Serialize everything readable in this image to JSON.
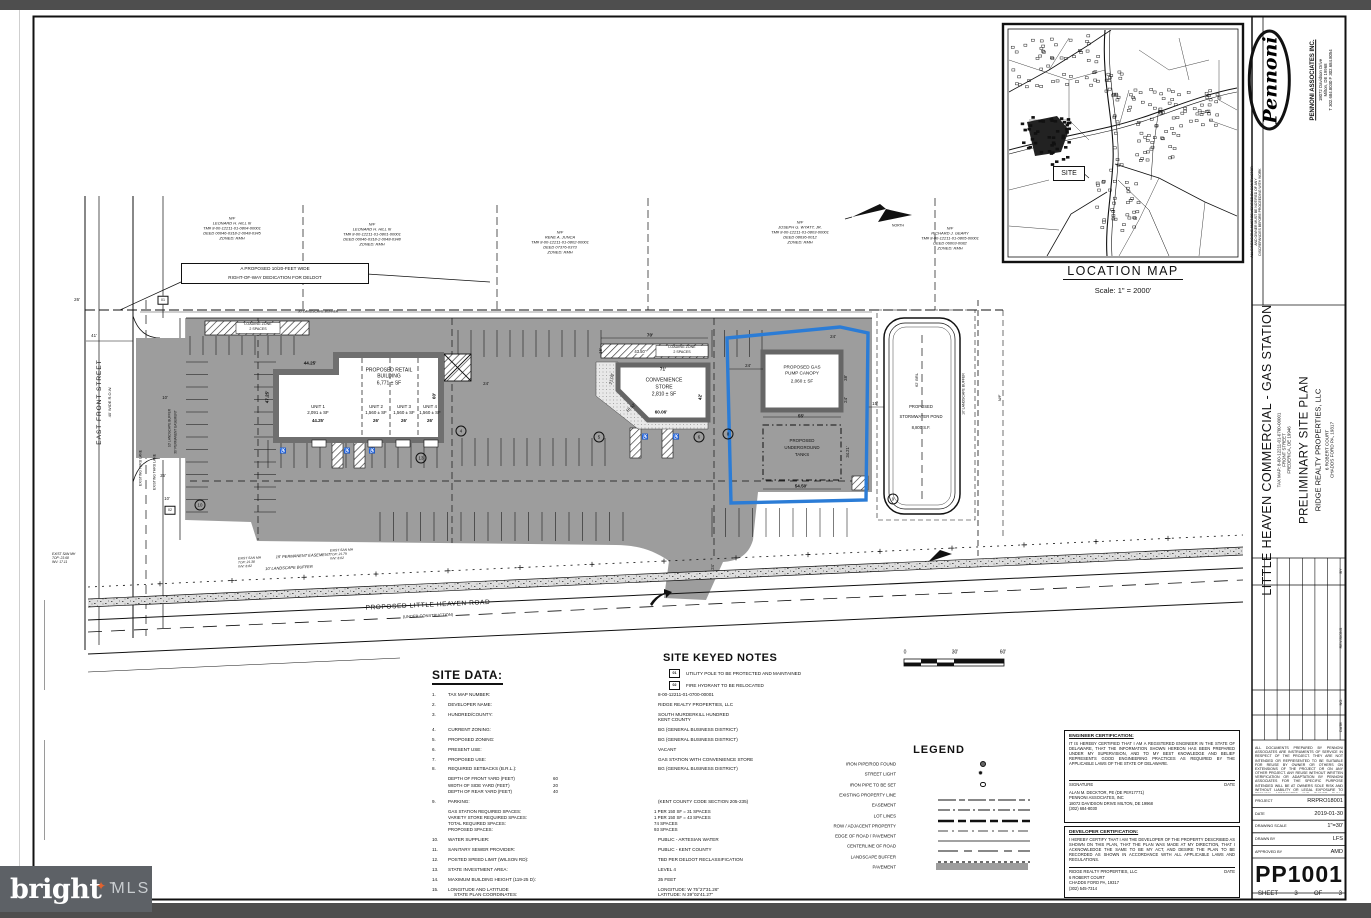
{
  "watermark": {
    "brand": "bright",
    "suffix": "MLS",
    "tm": "™",
    "star": "✦"
  },
  "titleblock": {
    "firm": {
      "logo_text": "Pennoni",
      "name": "PENNONI ASSOCIATES INC.",
      "address1": "18072 Davidson Drive",
      "address2": "Milton, DE 19968",
      "phone": "T 302.684.8030    F 302.684.8054"
    },
    "vertical_note_lines": [
      "ALL DIMENSIONS MUST BE VERIFIED BY CONTRACTOR",
      "AND OWNER MUST BE NOTIFIED OF ANY",
      "DISCREPANCIES BEFORE PROCEEDING WITH WORK"
    ],
    "project": {
      "title": "LITTLE HEAVEN COMMERCIAL - GAS STATION",
      "tax_map": "TAX MAP: 8-00-12211-01-0700-00001",
      "street": "FRONT STREET",
      "city": "FREDERICA, DE 19946",
      "plan_type": "PRELIMINARY SITE PLAN",
      "client_name": "RIDGE REALTY PROPERTIES, LLC",
      "client_address1": "6 ROBERT COURT",
      "client_address2": "CHADDS FORD PA, 19317"
    },
    "revisions": {
      "label": "REVISIONS",
      "col_no": "NO.",
      "col_date": "DATE",
      "col_by": "BY"
    },
    "reuse_note": "ALL DOCUMENTS PREPARED BY PENNONI ASSOCIATES ARE INSTRUMENTS OF SERVICE IN RESPECT OF THE PROJECT. THEY ARE NOT INTENDED OR REPRESENTED TO BE SUITABLE FOR REUSE BY OWNER OR OTHERS ON EXTENSIONS OF THE PROJECT OR ON ANY OTHER PROJECT. ANY REUSE WITHOUT WRITTEN VERIFICATION OR ADAPTATION BY PENNONI ASSOCIATES FOR THE SPECIFIC PURPOSE INTENDED WILL BE AT OWNERS SOLE RISK AND WITHOUT LIABILITY OR LEGAL EXPOSURE TO PENNONI ASSOCIATES AND OWNER SHALL INDEMNIFY AND HOLD HARMLESS PENNONI ASSOCIATES FROM ALL CLAIMS, DAMAGES, LOSSES AND EXPENSES ARISING OUT OF OR RESULTING THEREFROM.",
    "info_rows": [
      {
        "label": "PROJECT",
        "value": "RRPRO18001"
      },
      {
        "label": "DATE",
        "value": "2019-01-30"
      },
      {
        "label": "DRAWING SCALE",
        "value": "1\"=30'"
      },
      {
        "label": "DRAWN BY",
        "value": "LFS"
      },
      {
        "label": "APPROVED BY",
        "value": "AMD"
      }
    ],
    "sheet_number": "PP1001",
    "sheet_label": "SHEET",
    "sheet_page": "3",
    "sheet_of": "OF",
    "sheet_total": "3"
  },
  "location_map": {
    "title": "LOCATION MAP",
    "scale": "Scale: 1\" = 2000'",
    "site_label": "SITE"
  },
  "scale_bar": {
    "zero": "0",
    "mid": "30'",
    "end": "60'"
  },
  "plan": {
    "labels": [
      {
        "t": "EAST FRONT STREET",
        "x": 100,
        "y": 402,
        "r": -90,
        "s": 6.5,
        "ls": 1,
        "n": "east-front-street-label"
      },
      {
        "t": "40' WIDE R.O.W.",
        "x": 110,
        "y": 402,
        "r": -90,
        "s": 4
      },
      {
        "t": "EXISTING THRU LANE",
        "x": 141,
        "y": 468,
        "r": -90,
        "s": 3.4
      },
      {
        "t": "EXISTING THRU LANE",
        "x": 155,
        "y": 472,
        "r": -90,
        "s": 3.4
      },
      {
        "t": "PROPOSED LITTLE HEAVEN ROAD",
        "x": 428,
        "y": 606,
        "r": -2.6,
        "s": 6.5,
        "ls": 0.6,
        "n": "little-heaven-road-label"
      },
      {
        "t": "(UNDER CONSTRUCTION)",
        "x": 428,
        "y": 616,
        "r": -2.6,
        "s": 4
      },
      {
        "t": "15' PERMANENT EASEMENT",
        "x": 303,
        "y": 556,
        "r": -2.6,
        "s": 4,
        "i": 1
      },
      {
        "t": "10' LANDSCAPE BUFFER",
        "x": 289,
        "y": 568,
        "r": -2.6,
        "s": 4,
        "i": 1
      },
      {
        "t": "30' LANDSCAPE BUFFER",
        "x": 318,
        "y": 312,
        "s": 3.4,
        "i": 1
      },
      {
        "t": "10' LANDSCAPE BUFFER",
        "x": 170,
        "y": 428,
        "r": -90,
        "s": 3.2
      },
      {
        "t": "30' PERMANENT EASEMENT",
        "x": 176,
        "y": 432,
        "r": -90,
        "s": 3.2
      },
      {
        "t": "10' LANDSCAPE BUFFER",
        "x": 964,
        "y": 394,
        "r": -90,
        "s": 3.5
      },
      {
        "t": "62' BRL",
        "x": 917,
        "y": 380,
        "r": -90,
        "s": 4
      },
      {
        "t": "N/F",
        "x": 1000,
        "y": 398,
        "r": -90,
        "s": 4,
        "i": 1
      },
      {
        "t": "NORTH",
        "x": 898,
        "y": 226,
        "s": 3.4,
        "n": "north-arrow-label"
      },
      {
        "t": "PROPOSED RETAIL",
        "x": 389,
        "y": 371,
        "s": 5,
        "n": "retail-building-label"
      },
      {
        "t": "BUILDING",
        "x": 389,
        "y": 377,
        "s": 5
      },
      {
        "t": "6,771 ± SF",
        "x": 389,
        "y": 384,
        "s": 5
      },
      {
        "t": "UNIT 1",
        "x": 318,
        "y": 407,
        "s": 4.4
      },
      {
        "t": "2,091 ± SF",
        "x": 318,
        "y": 413,
        "s": 4.4
      },
      {
        "t": "44.25'",
        "x": 318,
        "y": 421,
        "s": 4.4,
        "b": 1
      },
      {
        "t": "UNIT 2",
        "x": 376,
        "y": 407,
        "s": 4.4
      },
      {
        "t": "1,560 ± SF",
        "x": 376,
        "y": 413,
        "s": 4.4
      },
      {
        "t": "26'",
        "x": 376,
        "y": 421,
        "s": 4.4,
        "b": 1
      },
      {
        "t": "UNIT 3",
        "x": 404,
        "y": 407,
        "s": 4.4
      },
      {
        "t": "1,560 ± SF",
        "x": 404,
        "y": 413,
        "s": 4.4
      },
      {
        "t": "26'",
        "x": 404,
        "y": 421,
        "s": 4.4,
        "b": 1
      },
      {
        "t": "UNIT 4",
        "x": 430,
        "y": 407,
        "s": 4.4
      },
      {
        "t": "1,560 ± SF",
        "x": 430,
        "y": 413,
        "s": 4.4
      },
      {
        "t": "26'",
        "x": 430,
        "y": 421,
        "s": 4.4,
        "b": 1
      },
      {
        "t": "44.25'",
        "x": 310,
        "y": 364,
        "s": 4.6,
        "b": 1
      },
      {
        "t": "47.25'",
        "x": 268,
        "y": 397,
        "r": -90,
        "s": 4.6,
        "b": 1
      },
      {
        "t": "60'",
        "x": 435,
        "y": 396,
        "r": -90,
        "s": 4.6,
        "b": 1
      },
      {
        "t": "24'",
        "x": 486,
        "y": 384,
        "s": 4.4
      },
      {
        "t": "CONVENIENCE",
        "x": 664,
        "y": 381,
        "s": 5,
        "n": "convenience-store-label"
      },
      {
        "t": "STORE",
        "x": 664,
        "y": 388,
        "s": 5
      },
      {
        "t": "2,810 ± SF",
        "x": 664,
        "y": 395,
        "s": 5
      },
      {
        "t": "71'",
        "x": 663,
        "y": 370,
        "s": 4.6,
        "b": 1
      },
      {
        "t": "21.08'",
        "x": 612,
        "y": 379,
        "r": -78,
        "s": 4.2
      },
      {
        "t": "18.52'",
        "x": 631,
        "y": 408,
        "r": -42,
        "s": 4.2
      },
      {
        "t": "60.06'",
        "x": 661,
        "y": 413,
        "s": 4.6,
        "b": 1
      },
      {
        "t": "42'",
        "x": 701,
        "y": 397,
        "r": -90,
        "s": 4.6,
        "b": 1
      },
      {
        "t": "70'",
        "x": 650,
        "y": 336,
        "s": 4.6,
        "b": 1
      },
      {
        "t": "15'",
        "x": 601,
        "y": 351,
        "r": -90,
        "s": 4.2
      },
      {
        "t": "43.50'",
        "x": 640,
        "y": 352,
        "s": 4.2,
        "bg": 1
      },
      {
        "t": "LOADING ZONE",
        "x": 682,
        "y": 348,
        "s": 3.6,
        "bg": 1
      },
      {
        "t": "2 SPACES",
        "x": 682,
        "y": 353,
        "s": 3.6,
        "bg": 1
      },
      {
        "t": "LOADING ZONE",
        "x": 258,
        "y": 325,
        "s": 3.6,
        "bg": 1
      },
      {
        "t": "2 SPACES",
        "x": 258,
        "y": 330,
        "s": 3.6,
        "bg": 1
      },
      {
        "t": "PROPOSED GAS",
        "x": 802,
        "y": 368,
        "s": 4.6,
        "n": "gas-canopy-label"
      },
      {
        "t": "PUMP CANOPY",
        "x": 802,
        "y": 374,
        "s": 4.6
      },
      {
        "t": "2,060 ± SF",
        "x": 802,
        "y": 382,
        "s": 4.6
      },
      {
        "t": "24'",
        "x": 748,
        "y": 366,
        "s": 4.4
      },
      {
        "t": "24'",
        "x": 833,
        "y": 337,
        "s": 4.4
      },
      {
        "t": "38'",
        "x": 846,
        "y": 378,
        "r": -90,
        "s": 4.4
      },
      {
        "t": "24'",
        "x": 846,
        "y": 400,
        "r": -90,
        "s": 4.4
      },
      {
        "t": "55'",
        "x": 801,
        "y": 417,
        "s": 4.6,
        "b": 1
      },
      {
        "t": "PROPOSED",
        "x": 802,
        "y": 441,
        "s": 4.4,
        "n": "underground-tanks-label"
      },
      {
        "t": "UNDERGROUND",
        "x": 802,
        "y": 448,
        "s": 4.4
      },
      {
        "t": "TANKS",
        "x": 802,
        "y": 455,
        "s": 4.4
      },
      {
        "t": "54.50'",
        "x": 801,
        "y": 487,
        "s": 4.6,
        "b": 1
      },
      {
        "t": "34.21'",
        "x": 848,
        "y": 452,
        "r": -90,
        "s": 4.2
      },
      {
        "t": "15'",
        "x": 875,
        "y": 404,
        "s": 4.4
      },
      {
        "t": "PROPOSED",
        "x": 921,
        "y": 407,
        "s": 4.2,
        "n": "stormwater-pond-label"
      },
      {
        "t": "STORMWATER POND",
        "x": 921,
        "y": 417,
        "s": 4.2
      },
      {
        "t": "8,800 S.F.",
        "x": 921,
        "y": 428,
        "s": 4.2
      },
      {
        "t": "41'",
        "x": 94,
        "y": 336,
        "s": 4.4
      },
      {
        "t": "26'",
        "x": 77,
        "y": 300,
        "s": 4.4
      },
      {
        "t": "10'",
        "x": 165,
        "y": 398,
        "s": 4.2
      },
      {
        "t": "25'",
        "x": 163,
        "y": 476,
        "s": 4.2
      },
      {
        "t": "10'",
        "x": 167,
        "y": 499,
        "s": 4.2
      },
      {
        "t": "24'",
        "x": 713,
        "y": 567,
        "r": -90,
        "s": 4.2
      }
    ],
    "parcels": [
      {
        "x": 232,
        "y": 228,
        "lines": [
          "N/F",
          "LEONARD H. HILL III",
          "TM# 8-00-12211-01-0804-00001",
          "DEED 00046-0318-2-0048-0345",
          "ZONED: RMH"
        ]
      },
      {
        "x": 372,
        "y": 234,
        "lines": [
          "N/F",
          "LEONARD H. HILL III",
          "TM# 8-00-12211-01-0801-00001",
          "DEED 00046-0318-2-0048-0348",
          "ZONED: RMH"
        ]
      },
      {
        "x": 560,
        "y": 242,
        "lines": [
          "N/F",
          "RENE A. JUNCA",
          "TM# 8-00-12211-01-0802-00001",
          "DEED 07376-0373",
          "ZONED: RMH"
        ]
      },
      {
        "x": 800,
        "y": 232,
        "lines": [
          "N/F",
          "JOSEPH G. WYATT, JR.",
          "TM# 8-00-12211-01-0803-00001",
          "DEED 08636-0012",
          "ZONED: RMH"
        ]
      },
      {
        "x": 950,
        "y": 238,
        "lines": [
          "N/F",
          "RICHARD J. GEARY",
          "TM# 8-00-12211-01-0805-00001",
          "DEED 06003-0082",
          "ZONED: RMH"
        ]
      }
    ],
    "callout": {
      "lines": [
        "A PROPOSED 10/20-FEET WIDE",
        "RIGHT-OF-WAY DEDICATION FOR DELDOT"
      ]
    },
    "mh_notes": [
      {
        "x": 52,
        "y": 552,
        "lines": [
          "EXIST SAN MH",
          "TOP: 23.68",
          "INV: 17.11"
        ]
      },
      {
        "x": 238,
        "y": 556,
        "r": -2.6,
        "lines": [
          "EXIST SAN MH",
          "TOP: 21.38",
          "INV: 8.82"
        ]
      },
      {
        "x": 330,
        "y": 548,
        "r": -2.6,
        "lines": [
          "EXIST SAN MH",
          "TOP: 21.79",
          "INV: 8.02"
        ]
      }
    ],
    "keyed_boxes": [
      {
        "key": "01",
        "x": 163,
        "y": 300
      },
      {
        "key": "02",
        "x": 170,
        "y": 510
      }
    ],
    "parking_counts": [
      {
        "v": "4",
        "x": 461,
        "y": 431
      },
      {
        "v": "5",
        "x": 599,
        "y": 437
      },
      {
        "v": "6",
        "x": 699,
        "y": 437
      },
      {
        "v": "8",
        "x": 728,
        "y": 434
      },
      {
        "v": "13",
        "x": 421,
        "y": 458
      },
      {
        "v": "10",
        "x": 200,
        "y": 505
      },
      {
        "v": "9",
        "x": 893,
        "y": 499
      }
    ],
    "handicap": {
      "symbol": "♿",
      "positions": [
        {
          "x": 283,
          "y": 452
        },
        {
          "x": 347,
          "y": 452
        },
        {
          "x": 372,
          "y": 452
        },
        {
          "x": 645,
          "y": 438
        },
        {
          "x": 676,
          "y": 438
        }
      ]
    }
  },
  "site_data": {
    "title": "SITE DATA:",
    "rows": [
      {
        "num": "1.",
        "label": "TAX MAP NUMBER:",
        "value": "8-00-12211-01-0700-00001"
      },
      {
        "num": "2.",
        "label": "DEVELOPER NAME:",
        "value": "RIDGE REALTY PROPERTIES, LLC"
      },
      {
        "num": "3.",
        "label": "HUNDRED/COUNTY:",
        "value": "SOUTH MURDERKILL HUNDRED",
        "value2": "KENT COUNTY"
      },
      {
        "num": "4.",
        "label": "CURRENT ZONING:",
        "value": "BG (GENERAL BUSINESS DISTRICT)"
      },
      {
        "num": "5.",
        "label": "PROPOSED ZONING:",
        "value": "BG (GENERAL BUSINESS DISTRICT)"
      },
      {
        "num": "6.",
        "label": "PRESENT USE:",
        "value": "VACANT"
      },
      {
        "num": "7.",
        "label": "PROPOSED USE:",
        "value": "GAS STATION WITH CONVENIENCE STORE"
      },
      {
        "num": "8.",
        "label": "REQUIRED SETBACKS (B.R.L.):",
        "value": "BG (GENERAL BUSINESS DISTRICT)",
        "sw": 105,
        "subs": [
          {
            "l": "DEPTH OF FRONT YARD (FEET)",
            "v": "60"
          },
          {
            "l": "WIDTH OF SIDE YARD (FEET)",
            "v": "20"
          },
          {
            "l": "DEPTH OF REAR YARD (FEET)",
            "v": "40"
          }
        ]
      },
      {
        "num": "9.",
        "label": "PARKING:",
        "value": "(KENT COUNTY CODE SECTION 205-235)",
        "sw": 206,
        "subs": [
          {
            "l": "GAS STATION REQUIRED SPACES:",
            "v": "1 PER 150 SF = 31 SPACES"
          },
          {
            "l": "VARIETY STORE REQUIRED SPACES:",
            "v": "1 PER 150 SF = 43 SPACES"
          },
          {
            "l": "TOTAL REQUIRED SPACES:",
            "v": "74 SPACES"
          },
          {
            "l": "PROPOSED SPACES:",
            "v": "93 SPACES"
          }
        ]
      },
      {
        "num": "10.",
        "label": "WATER SUPPLIER:",
        "value": "PUBLIC - ARTESIAN WATER"
      },
      {
        "num": "11.",
        "label": "SANITARY SEWER PROVIDER:",
        "value": "PUBLIC - KENT COUNTY"
      },
      {
        "num": "12.",
        "label": "POSTED SPEED LIMIT (WILSON RD):",
        "value": "TBD PER DELDOT RECLASSIFICATION"
      },
      {
        "num": "13.",
        "label": "STATE INVESTMENT AREA:",
        "value": "LEVEL 4"
      },
      {
        "num": "14.",
        "label": "MAXIMUM BUILDING HEIGHT (119-25 D):",
        "value": "35 FEET"
      },
      {
        "num": "15.",
        "label": "LONGITUDE AND LATITUDE",
        "label2": "STATE PLAN COORDINATES:",
        "value": "LONGITUDE: W 75°27'31.26\"",
        "value2": "LATITUDE: N 39°02'41.27\""
      }
    ]
  },
  "keyed_notes": {
    "title": "SITE KEYED NOTES",
    "items": [
      {
        "key": "01",
        "text": "UTILITY POLE TO BE PROTECTED AND MAINTAINED"
      },
      {
        "key": "02",
        "text": "FIRE HYDRANT TO BE RELOCATED"
      }
    ]
  },
  "legend": {
    "title": "LEGEND",
    "items": [
      {
        "label": "IRON PIPE/ROD FOUND",
        "sym": "iron_found"
      },
      {
        "label": "STREET LIGHT",
        "sym": "street_light"
      },
      {
        "label": "IRON PIPE TO BE SET",
        "sym": "iron_set"
      },
      {
        "label": "EXISTING PROPERTY LINE",
        "sym": "prop_line"
      },
      {
        "label": "EASEMENT",
        "sym": "easement"
      },
      {
        "label": "LOT LINES",
        "sym": "lot_line"
      },
      {
        "label": "ROW / ADJACENT PROPERTY",
        "sym": "row_line"
      },
      {
        "label": "EDGE OF ROAD / PAVEMENT",
        "sym": "edge_road"
      },
      {
        "label": "CENTERLINE OF ROAD",
        "sym": "centerline"
      },
      {
        "label": "LANDSCAPE BUFFER",
        "sym": "buffer"
      },
      {
        "label": "PAVEMENT",
        "sym": "pavement"
      }
    ]
  },
  "certs": {
    "engineer": {
      "title": "ENGINEER CERTIFICATION:",
      "body": "IT IS HEREBY CERTIFIED THAT I AM A REGISTERED ENGINEER IN THE STATE OF DELAWARE, THAT THE INFORMATION SHOWN HEREON HAS BEEN PREPARED UNDER MY SUPERVISION, AND TO MY BEST KNOWLEDGE AND BELIEF REPRESENTS GOOD ENGINEERING PRACTICES AS REQUIRED BY THE APPLICABLE LAWS OF THE STATE OF DELAWARE.",
      "sig_label": "SIGNATURE",
      "date_label": "DATE",
      "lines": [
        "ALAN M. DECKTOR, PE    (DE PE#17771)",
        "PENNONI ASSOCIATES, INC",
        "18072 DAVIDSON DRIVE MILTON, DE 19968",
        "(302) 684-8030"
      ]
    },
    "developer": {
      "title": "DEVELOPER CERTIFICATION:",
      "body": "I HEREBY CERTIFY THAT I AM THE DEVELOPER OF THE PROPERTY DESCRIBED AS SHOWN ON THIS PLAN, THAT THE PLAN WAS MADE AT MY DIRECTION, THAT I ACKNOWLEDGE THE SAME TO BE MY ACT, AND DESIRE THE PLAN TO BE RECORDED AS SHOWN IN ACCORDANCE WITH ALL APPLICABLE LAWS AND REGULATIONS.",
      "name_label": "RIDGE REALTY PROPERTIES, LLC",
      "date_label": "DATE",
      "lines": [
        "6 ROBERT COURT",
        "CHADDS FORD PA, 19317",
        "(302) 545-7314"
      ]
    }
  }
}
